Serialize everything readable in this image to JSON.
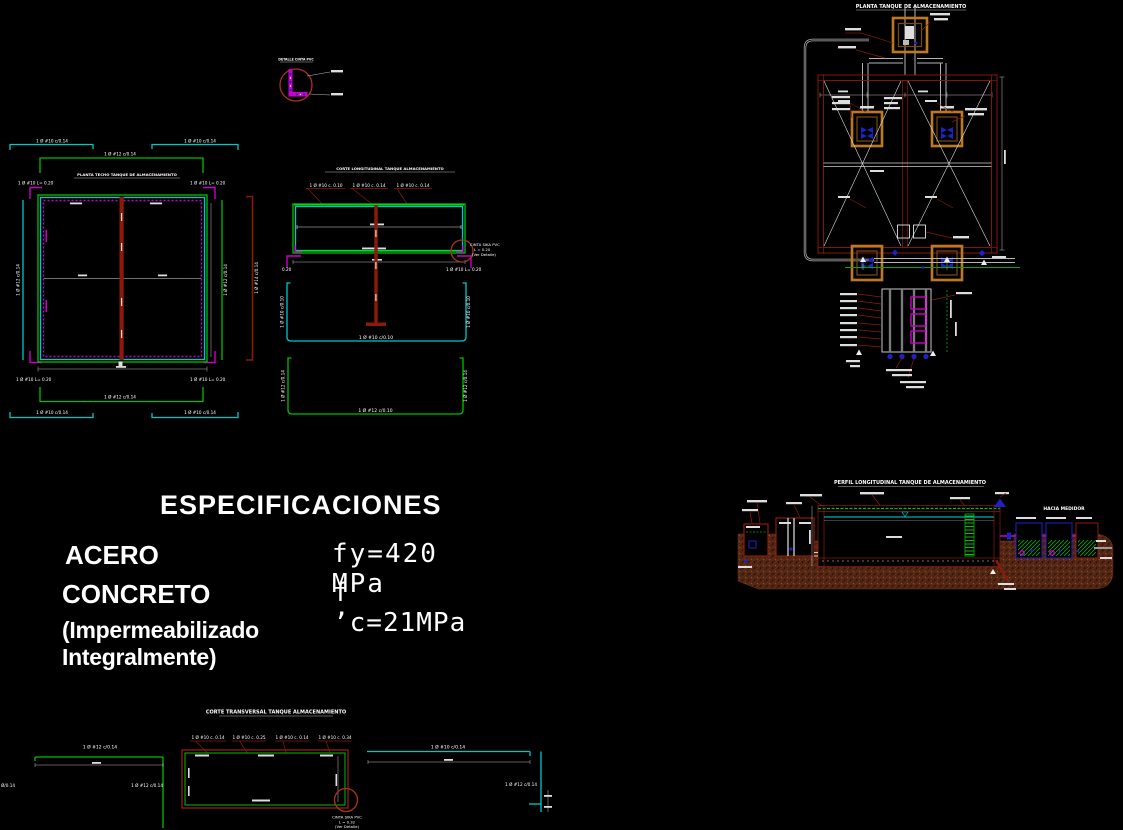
{
  "canvas": {
    "background": "#000000"
  },
  "colors": {
    "green": "#00c000",
    "cyan": "#00c8c8",
    "magenta": "#c800c8",
    "dark_red": "#8c1a0b",
    "orange": "#c07820",
    "pipe_gray": "#b5b5b5",
    "blue": "#2020c8",
    "ground_brown": "#5a2a16",
    "white": "#ffffff"
  },
  "specifications": {
    "title": "ESPECIFICACIONES",
    "steel_label": "ACERO",
    "steel_value": "fy=420  MPa",
    "concrete_label": "CONCRETO",
    "concrete_value": "f ’c=21MPa",
    "note": "(Impermeabilizado Integralmente)"
  },
  "plan_roof": {
    "title": "PLANTA TECHO TANQUE DE ALMACENAMIENTO",
    "rebar_outer_top_left": "1 Ø #10 c/0.14",
    "rebar_outer_top_right": "1 Ø #10 c/0.14",
    "rebar_bracket_top": "1 Ø #12 c/0.14",
    "hook_top_left": "1 Ø #10 L= 0.20",
    "hook_top_right": "1 Ø #10 L= 0.20",
    "rebar_side_left": "1 Ø #12 c/0.14",
    "rebar_side_right": "1 Ø #12 c/0.14",
    "rebar_side_red": "1 Ø #14 c/0.14",
    "hook_bottom_left": "1 Ø #10 L= 0.20",
    "hook_bottom_right": "1 Ø #10 L= 0.20",
    "rebar_bracket_bottom": "1 Ø #12 c/0.14",
    "rebar_outer_bottom_left": "1 Ø #10 c/0.14",
    "rebar_outer_bottom_right": "1 Ø #10 c/0.14"
  },
  "section_long": {
    "title": "CORTE LONGITUDINAL TANQUE ALMACENAMIENTO",
    "rebar_1": "1 Ø #10 c. 0.10",
    "rebar_2": "1 Ø #10 c. 0.14",
    "rebar_3": "1 Ø #10 c. 0.14",
    "hook_left": "0.20",
    "hook_right": "1 Ø #10 L= 0.20",
    "waterstop_1": "CINTA SIKA PVC",
    "waterstop_2": "L = 0.20",
    "waterstop_3": "(Ver Detalle)"
  },
  "channel_top": {
    "side_left": "1 Ø #10 c/0.10",
    "side_right": "1 Ø #10 c/0.10",
    "bottom": "1 Ø #10 c/0.10"
  },
  "channel_bottom": {
    "side_left": "1 Ø #12 c/0.14",
    "side_right": "1 Ø #12 c/0.14",
    "bottom": "1 Ø #12 c/0.10"
  },
  "detail_waterstop": {
    "title": "DETALLE CINTA PVC"
  },
  "plan_tank": {
    "title": "PLANTA TANQUE DE ALMACENAMIENTO"
  },
  "profile": {
    "title": "PERFIL LONGITUDINAL TANQUE DE ALMACENAMIENTO",
    "to_meter": "HACIA MEDIDOR"
  },
  "section_trans": {
    "title": "CORTE TRANSVERSAL TANQUE ALMACENAMIENTO",
    "rebar_row": [
      "1 Ø #10 c. 0.14",
      "1 Ø #10 c. 0.25",
      "1 Ø #10 c. 0.14",
      "1 Ø #10 c. 0.34"
    ],
    "left_top": "1 Ø #12 c/0.14",
    "left_inner": "1 Ø #12 c/0.14",
    "left_edge": "Ø/0.14",
    "right_top": "1 Ø #10 c/0.14",
    "right_inner": "1 Ø #12 c/0.14",
    "waterstop_1": "CINTA SIKA PVC",
    "waterstop_2": "L = 0.32",
    "waterstop_3": "(Ver Detalle)"
  }
}
